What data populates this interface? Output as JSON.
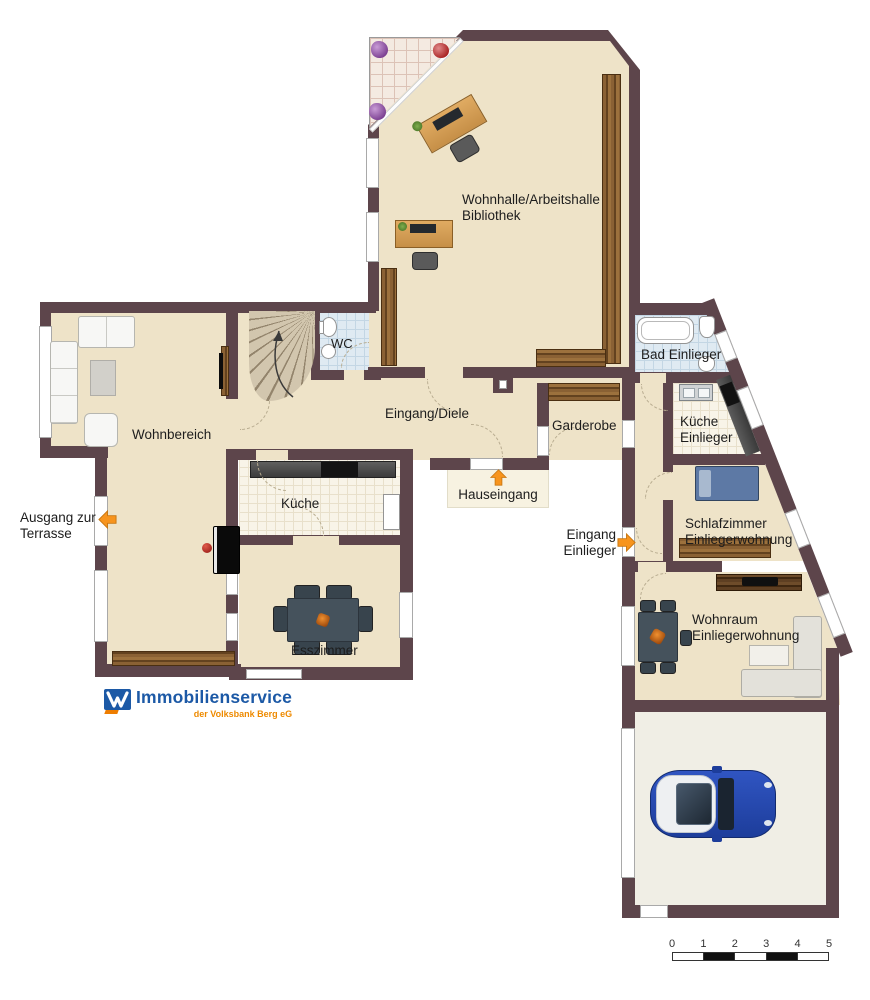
{
  "plan": {
    "rooms": {
      "wohnhalle": "Wohnhalle/Arbeitshalle\nBibliothek",
      "wohnbereich": "Wohnbereich",
      "wc": "WC",
      "eingang_diele": "Eingang/Diele",
      "kueche": "Küche",
      "esszimmer": "Esszimmer",
      "garderobe": "Garderobe",
      "bad_einlieger": "Bad Einlieger",
      "kueche_einlieger": "Küche\nEinlieger",
      "schlafzimmer_einlieger": "Schlafzimmer\nEinliegerwohnung",
      "wohnraum_einlieger": "Wohnraum\nEinliegerwohnung"
    },
    "annotations": {
      "ausgang_terrasse": "Ausgang zur\nTerrasse",
      "hauseingang": "Hauseingang",
      "eingang_einlieger": "Eingang\nEinlieger"
    }
  },
  "logo": {
    "brand": "Immobilienservice",
    "subtitle": "der Volksbank Berg eG"
  },
  "scale": {
    "ticks": [
      "0",
      "1",
      "2",
      "3",
      "4",
      "5"
    ]
  },
  "colors": {
    "wall": "#5d454b",
    "floor": "#eee3c8",
    "bath_tile": "#dfeaf2",
    "kitchen_tile": "#f8f4e8",
    "terrace_tile": "#f4eae1",
    "arrow_orange": "#f7941d",
    "logo_blue": "#1c59a6",
    "logo_orange": "#ee7d00",
    "car_blue": "#2547b0",
    "wood_brown": "#7b5530"
  }
}
